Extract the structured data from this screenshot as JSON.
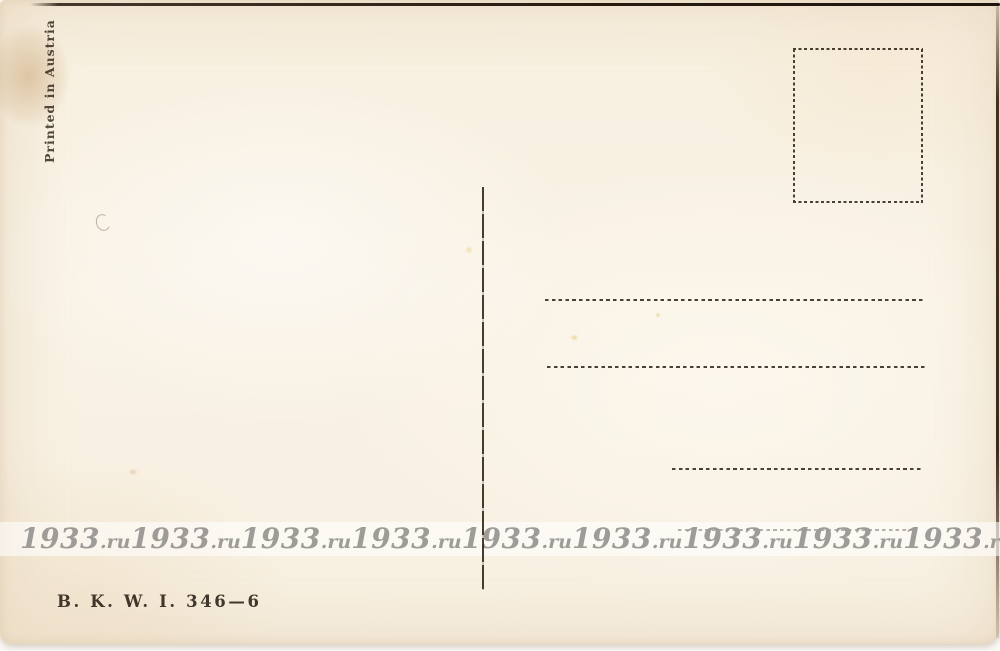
{
  "postcard": {
    "printing_note": "Printed in Austria",
    "publisher_code": "B. K. W. I. 346—6"
  },
  "watermark": {
    "number": "1933",
    "suffix": ".ru",
    "full_text": "1933.ru",
    "repeat_count": 9,
    "text_color": "#9e9c98"
  },
  "colors": {
    "paper": "#f8f1e3",
    "ink": "#2b2115",
    "scan_edge": "#3a2a1a",
    "watermark_band": "rgba(255,255,255,0.58)"
  }
}
